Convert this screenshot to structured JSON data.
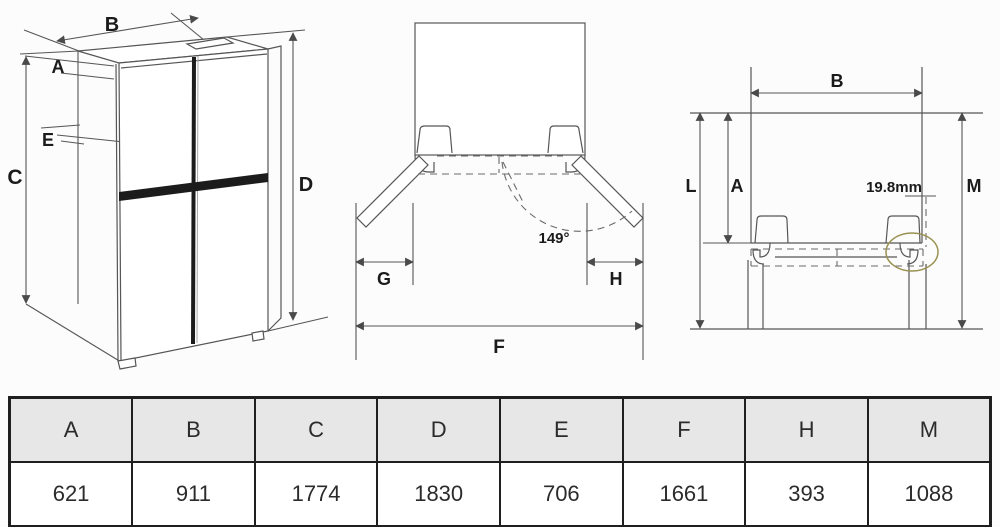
{
  "views": {
    "front": {
      "labels": {
        "b": "B",
        "a": "A",
        "e": "E",
        "c": "C",
        "d": "D"
      }
    },
    "top": {
      "labels": {
        "g": "G",
        "h": "H",
        "f": "F"
      },
      "angle": "149°"
    },
    "side": {
      "labels": {
        "b": "B",
        "l": "L",
        "a": "A",
        "m": "M"
      },
      "hinge_gap": "19.8mm"
    }
  },
  "table": {
    "headers": [
      "A",
      "B",
      "C",
      "D",
      "E",
      "F",
      "H",
      "M"
    ],
    "values": [
      "621",
      "911",
      "1774",
      "1830",
      "706",
      "1661",
      "393",
      "1088"
    ]
  },
  "colors": {
    "line": "#565656",
    "dark_bar": "#1c1c1c",
    "highlight_ellipse": "#9a9150",
    "table_header_bg": "#e7e7e7",
    "table_border": "#1f1f1f"
  }
}
